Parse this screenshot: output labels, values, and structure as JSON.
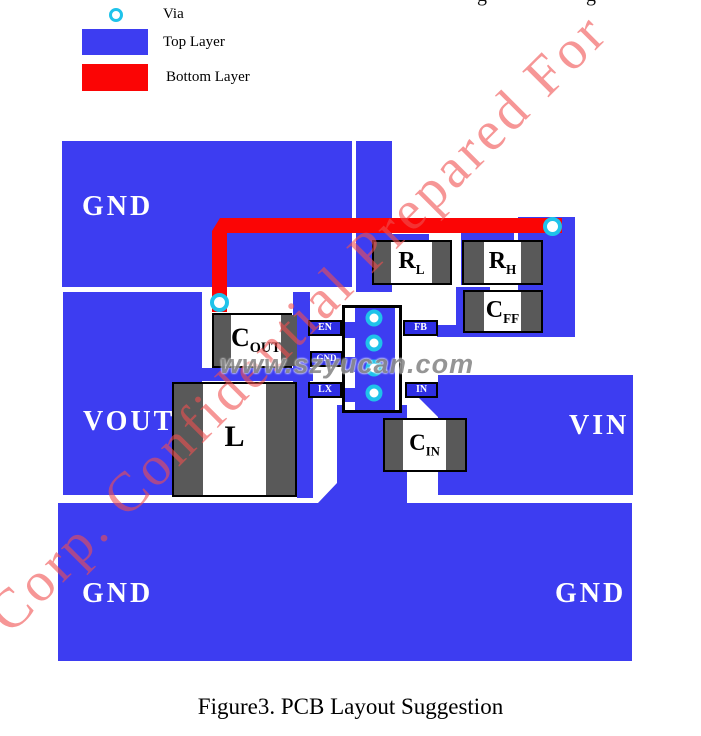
{
  "legend": {
    "via_label": "Via",
    "top_layer_label": "Top Layer",
    "bottom_layer_label": "Bottom Layer"
  },
  "planes": {
    "gnd_top": "GND",
    "vout": "VOUT",
    "vin": "VIN",
    "gnd_bottom_left": "GND",
    "gnd_bottom_right": "GND"
  },
  "pins": {
    "en": "EN",
    "gnd": "GND",
    "lx": "LX",
    "fb": "FB",
    "in": "IN"
  },
  "components": {
    "cout": {
      "main": "C",
      "sub": "OUT"
    },
    "l": {
      "main": "L",
      "sub": ""
    },
    "rl": {
      "main": "R",
      "sub": "L"
    },
    "rh": {
      "main": "R",
      "sub": "H"
    },
    "cff": {
      "main": "C",
      "sub": "FF"
    },
    "cin": {
      "main": "C",
      "sub": "IN"
    }
  },
  "watermarks": {
    "diagonal": "Corp. Confidential Prepared For",
    "website": "www.szyucan.com",
    "edge_fragment_left": "g",
    "edge_fragment_right": "g"
  },
  "caption": "Figure3. PCB Layout Suggestion",
  "colors": {
    "top_layer_blue": "#3d3df1",
    "bottom_layer_red": "#fb0505",
    "via_ring_cyan": "#1fc3ea",
    "pad_gray": "#595959",
    "pin_label_blue": "#2e2ee4",
    "watermark_pink": "rgba(240,80,80,0.6)",
    "watermark_gray": "#8d8d8d"
  }
}
